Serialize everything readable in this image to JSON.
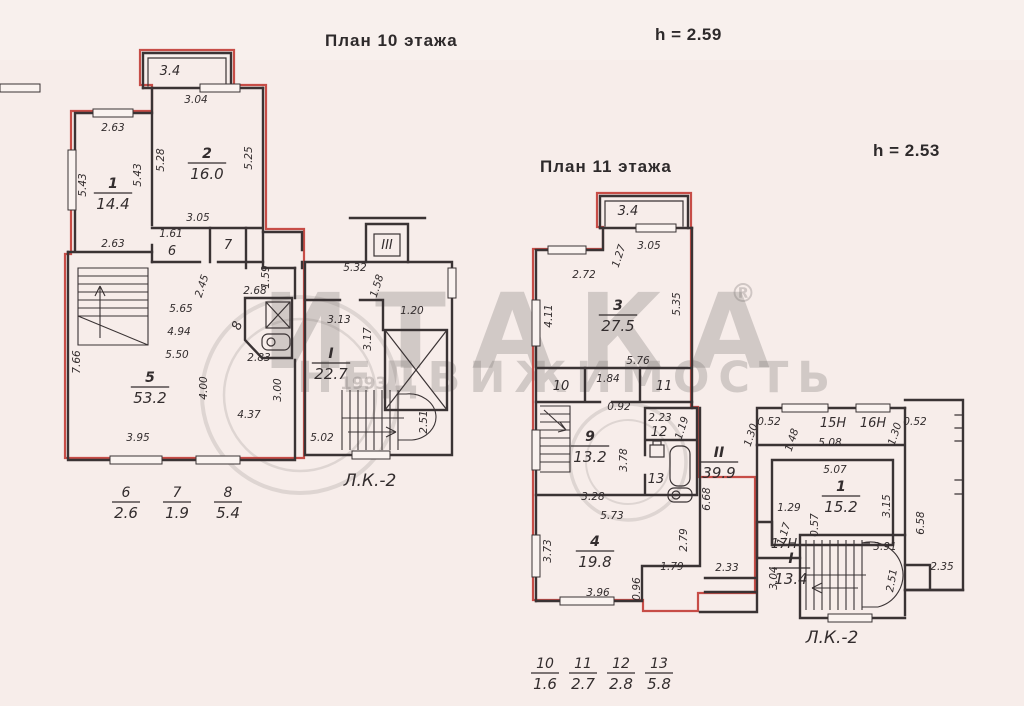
{
  "page": {
    "plan10_title": "План 10  этажа",
    "plan10_height": "h = 2.59",
    "plan11_title": "План 11  этажа",
    "plan11_height": "h = 2.53"
  },
  "watermark": {
    "brand": "ИТАКА",
    "reg": "®",
    "sub": "НЕДВИЖИМОСТЬ",
    "year": "1993"
  },
  "plan10": {
    "rooms": [
      {
        "num": "1",
        "area": "14.4",
        "x": 113,
        "y": 188
      },
      {
        "num": "2",
        "area": "16.0",
        "x": 207,
        "y": 158
      },
      {
        "num": "5",
        "area": "53.2",
        "x": 150,
        "y": 382
      },
      {
        "num": "I",
        "area": "22.7",
        "x": 331,
        "y": 358
      }
    ],
    "small_labels": [
      {
        "t": "3.4",
        "x": 170,
        "y": 75
      },
      {
        "t": "6",
        "x": 172,
        "y": 255
      },
      {
        "t": "7",
        "x": 228,
        "y": 249
      },
      {
        "t": "8",
        "x": 241,
        "y": 327,
        "r": -70
      },
      {
        "t": "III",
        "x": 387,
        "y": 249
      },
      {
        "t": "Л.К.-2",
        "x": 370,
        "y": 486
      }
    ],
    "dims": [
      {
        "t": "2.63",
        "x": 113,
        "y": 131
      },
      {
        "t": "5.43",
        "x": 86,
        "y": 185,
        "r": -90
      },
      {
        "t": "5.43",
        "x": 141,
        "y": 175,
        "r": -90
      },
      {
        "t": "2.63",
        "x": 113,
        "y": 247
      },
      {
        "t": "3.04",
        "x": 196,
        "y": 103
      },
      {
        "t": "5.28",
        "x": 164,
        "y": 160,
        "r": -90
      },
      {
        "t": "5.25",
        "x": 252,
        "y": 158,
        "r": -90
      },
      {
        "t": "3.05",
        "x": 198,
        "y": 221
      },
      {
        "t": "1.61",
        "x": 171,
        "y": 237
      },
      {
        "t": "5.65",
        "x": 181,
        "y": 312
      },
      {
        "t": "4.94",
        "x": 179,
        "y": 335
      },
      {
        "t": "5.50",
        "x": 177,
        "y": 358
      },
      {
        "t": "7.66",
        "x": 80,
        "y": 362,
        "r": -90
      },
      {
        "t": "3.95",
        "x": 138,
        "y": 441
      },
      {
        "t": "4.37",
        "x": 249,
        "y": 418
      },
      {
        "t": "4.00",
        "x": 207,
        "y": 388,
        "r": -90
      },
      {
        "t": "3.00",
        "x": 281,
        "y": 390,
        "r": -90
      },
      {
        "t": "2.45",
        "x": 205,
        "y": 287,
        "r": -72
      },
      {
        "t": "1.59",
        "x": 269,
        "y": 277,
        "r": -90
      },
      {
        "t": "2.68",
        "x": 255,
        "y": 294
      },
      {
        "t": "2.83",
        "x": 259,
        "y": 361
      },
      {
        "t": "5.32",
        "x": 355,
        "y": 271
      },
      {
        "t": "1.58",
        "x": 380,
        "y": 287,
        "r": -72
      },
      {
        "t": "3.13",
        "x": 339,
        "y": 323
      },
      {
        "t": "1.20",
        "x": 412,
        "y": 314
      },
      {
        "t": "3.17",
        "x": 371,
        "y": 339,
        "r": -90
      },
      {
        "t": "2.51",
        "x": 427,
        "y": 422,
        "r": -90
      },
      {
        "t": "5.02",
        "x": 322,
        "y": 441
      }
    ],
    "fractions": [
      {
        "num": "6",
        "den": "2.6",
        "x": 126,
        "y": 497
      },
      {
        "num": "7",
        "den": "1.9",
        "x": 177,
        "y": 497
      },
      {
        "num": "8",
        "den": "5.4",
        "x": 228,
        "y": 497
      }
    ]
  },
  "plan11": {
    "rooms": [
      {
        "num": "3",
        "area": "27.5",
        "x": 618,
        "y": 310
      },
      {
        "num": "9",
        "area": "13.2",
        "x": 590,
        "y": 441
      },
      {
        "num": "4",
        "area": "19.8",
        "x": 595,
        "y": 546
      },
      {
        "num": "II",
        "area": "39.9",
        "x": 719,
        "y": 457
      },
      {
        "num": "1",
        "area": "15.2",
        "x": 841,
        "y": 491
      },
      {
        "num": "I",
        "area": "13.4",
        "x": 791,
        "y": 563
      }
    ],
    "small_labels": [
      {
        "t": "3.4",
        "x": 628,
        "y": 215
      },
      {
        "t": "10",
        "x": 561,
        "y": 390
      },
      {
        "t": "11",
        "x": 664,
        "y": 390
      },
      {
        "t": "12",
        "x": 659,
        "y": 436
      },
      {
        "t": "13",
        "x": 656,
        "y": 483
      },
      {
        "t": "15Н",
        "x": 833,
        "y": 427
      },
      {
        "t": "16Н",
        "x": 873,
        "y": 427
      },
      {
        "t": "17Н",
        "x": 784,
        "y": 548
      },
      {
        "t": "Л.К.-2",
        "x": 832,
        "y": 643
      }
    ],
    "dims": [
      {
        "t": "3.05",
        "x": 649,
        "y": 249
      },
      {
        "t": "1.27",
        "x": 622,
        "y": 257,
        "r": -72
      },
      {
        "t": "2.72",
        "x": 584,
        "y": 278
      },
      {
        "t": "4.11",
        "x": 552,
        "y": 316,
        "r": -90
      },
      {
        "t": "5.35",
        "x": 680,
        "y": 304,
        "r": -90
      },
      {
        "t": "5.76",
        "x": 638,
        "y": 364
      },
      {
        "t": "1.84",
        "x": 608,
        "y": 382
      },
      {
        "t": "0.92",
        "x": 619,
        "y": 410
      },
      {
        "t": "2.23",
        "x": 660,
        "y": 421
      },
      {
        "t": "1.19",
        "x": 685,
        "y": 429,
        "r": -72
      },
      {
        "t": "3.78",
        "x": 627,
        "y": 460,
        "r": -90
      },
      {
        "t": "3.28",
        "x": 593,
        "y": 500
      },
      {
        "t": "5.73",
        "x": 612,
        "y": 519
      },
      {
        "t": "3.73",
        "x": 551,
        "y": 551,
        "r": -90
      },
      {
        "t": "2.79",
        "x": 687,
        "y": 540,
        "r": -90
      },
      {
        "t": "1.79",
        "x": 672,
        "y": 570
      },
      {
        "t": "0.96",
        "x": 640,
        "y": 589,
        "r": -90
      },
      {
        "t": "3.96",
        "x": 598,
        "y": 596
      },
      {
        "t": "2.33",
        "x": 727,
        "y": 571
      },
      {
        "t": "6.68",
        "x": 710,
        "y": 499,
        "r": -90
      },
      {
        "t": "0.52",
        "x": 769,
        "y": 425
      },
      {
        "t": "1.30",
        "x": 754,
        "y": 436,
        "r": -72
      },
      {
        "t": "1.48",
        "x": 795,
        "y": 441,
        "r": -72
      },
      {
        "t": "5.08",
        "x": 830,
        "y": 446
      },
      {
        "t": "0.52",
        "x": 915,
        "y": 425
      },
      {
        "t": "1.30",
        "x": 898,
        "y": 435,
        "r": -72
      },
      {
        "t": "5.07",
        "x": 835,
        "y": 473
      },
      {
        "t": "1.29",
        "x": 789,
        "y": 511
      },
      {
        "t": "3.15",
        "x": 890,
        "y": 506,
        "r": -90
      },
      {
        "t": "0.57",
        "x": 818,
        "y": 525,
        "r": -90
      },
      {
        "t": "1.17",
        "x": 787,
        "y": 535,
        "r": -72
      },
      {
        "t": "3.04",
        "x": 777,
        "y": 578,
        "r": -90
      },
      {
        "t": "3.91",
        "x": 885,
        "y": 550
      },
      {
        "t": "2.51",
        "x": 895,
        "y": 581,
        "r": -80
      },
      {
        "t": "6.58",
        "x": 924,
        "y": 523,
        "r": -90
      },
      {
        "t": "2.35",
        "x": 942,
        "y": 570
      }
    ],
    "fractions": [
      {
        "num": "10",
        "den": "1.6",
        "x": 545,
        "y": 668
      },
      {
        "num": "11",
        "den": "2.7",
        "x": 583,
        "y": 668
      },
      {
        "num": "12",
        "den": "2.8",
        "x": 621,
        "y": 668
      },
      {
        "num": "13",
        "den": "5.8",
        "x": 659,
        "y": 668
      }
    ]
  }
}
